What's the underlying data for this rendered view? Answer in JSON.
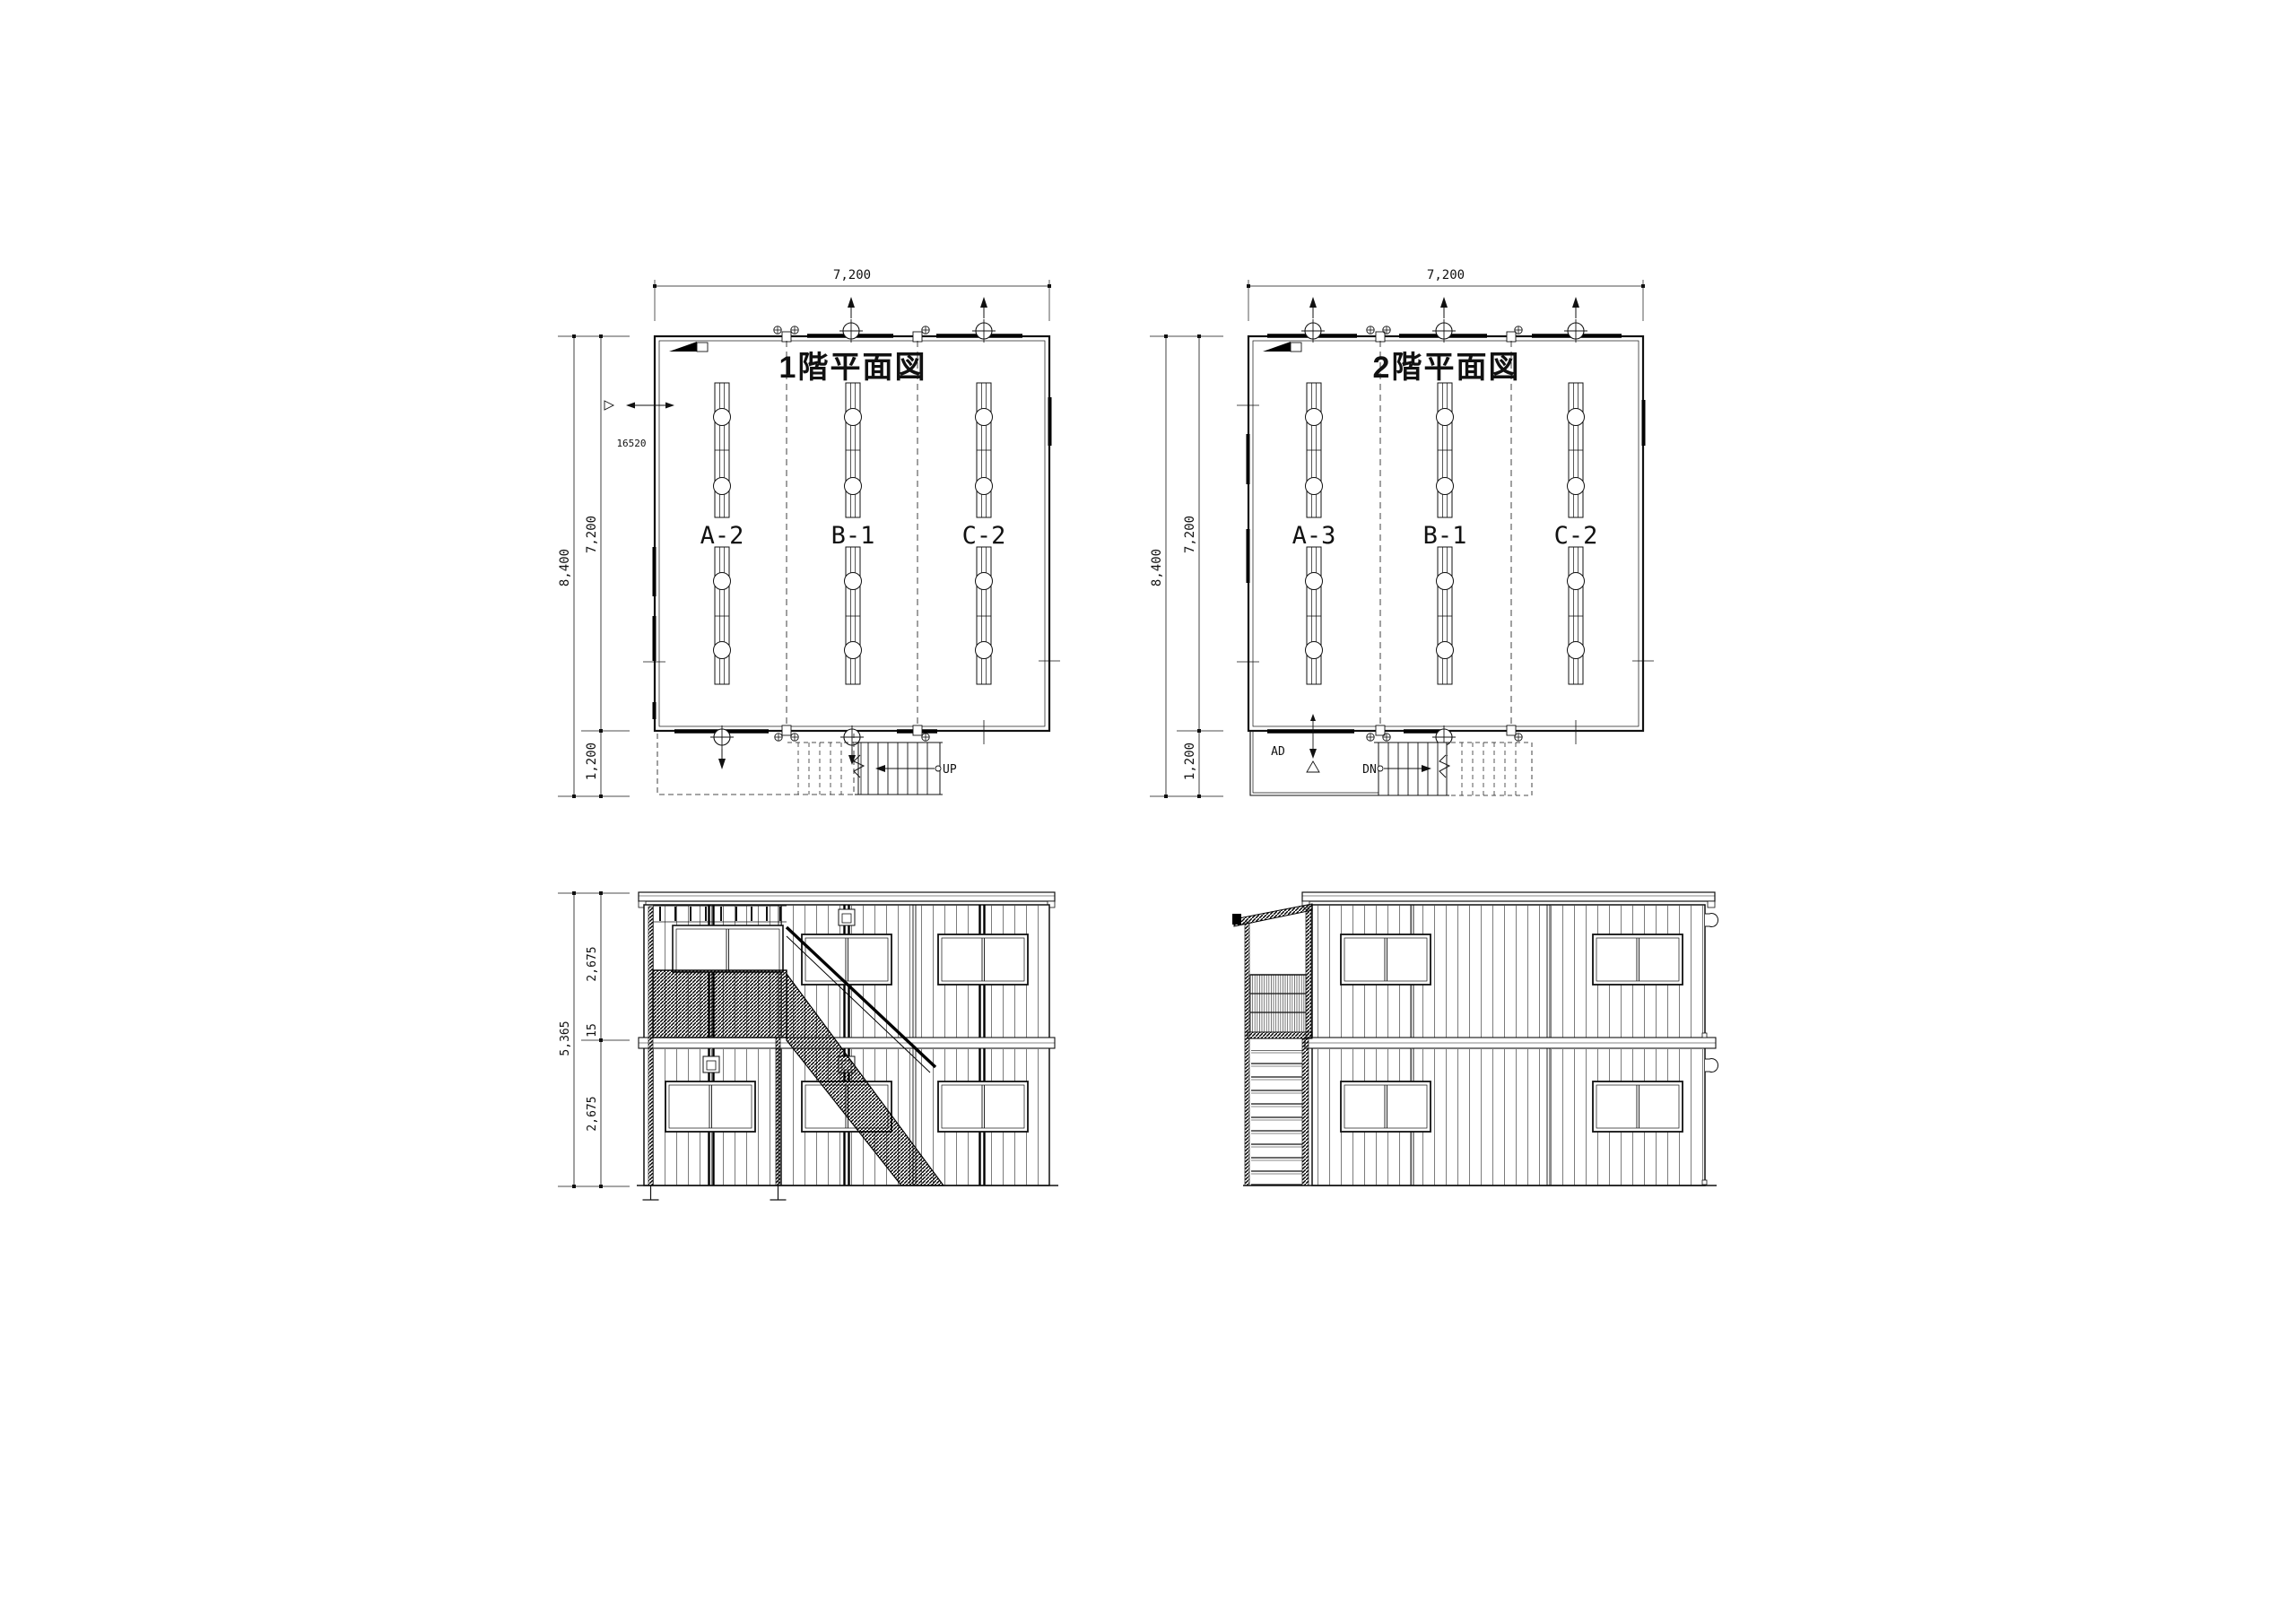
{
  "plan1": {
    "title": "1階平面図",
    "dim_top": "7,200",
    "dim_total": "8,400",
    "dim_main": "7,200",
    "dim_porch": "1,200",
    "window_tag": "16520",
    "bays": [
      "A-2",
      "B-1",
      "C-2"
    ],
    "stair_label": "UP"
  },
  "plan2": {
    "title": "2階平面図",
    "dim_top": "7,200",
    "dim_total": "8,400",
    "dim_main": "7,200",
    "dim_porch": "1,200",
    "bays": [
      "A-3",
      "B-1",
      "C-2"
    ],
    "stair_label": "DN",
    "duct_label": "AD"
  },
  "elevation_front": {
    "dim_total": "5,365",
    "dim_upper": "2,675",
    "dim_joint": "15",
    "dim_lower": "2,675"
  },
  "colors": {
    "line": "#111111",
    "thin": "#3a3a3a",
    "paper": "#ffffff"
  }
}
